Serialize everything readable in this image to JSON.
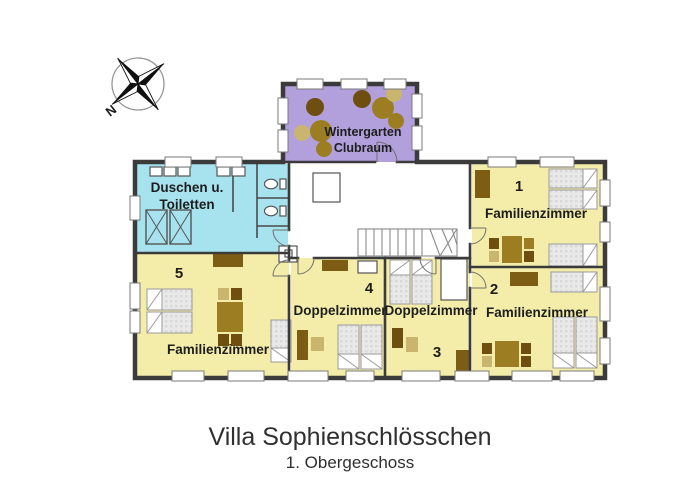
{
  "plan": {
    "title": "Villa Sophienschlösschen",
    "subtitle": "1. Obergeschoss",
    "compass": {
      "north": "N"
    },
    "rooms": {
      "wintergarten": {
        "line1": "Wintergarten",
        "line2": "Clubraum"
      },
      "sanitary": {
        "line1": "Duschen u.",
        "line2": "Toiletten"
      },
      "r1": {
        "number": "1",
        "label": "Familienzimmer"
      },
      "r2": {
        "number": "2",
        "label": "Familienzimmer"
      },
      "r3": {
        "number": "3",
        "label": "Doppelzimmer"
      },
      "r4": {
        "number": "4",
        "label": "Doppelzimmer"
      },
      "r5": {
        "number": "5",
        "label": "Familienzimmer"
      }
    },
    "colors": {
      "room_yellow": "#f3eda9",
      "wintergarten_purple": "#b2a0dd",
      "sanitary_cyan": "#a7e2ef",
      "wall": "#3b3b3b"
    }
  }
}
